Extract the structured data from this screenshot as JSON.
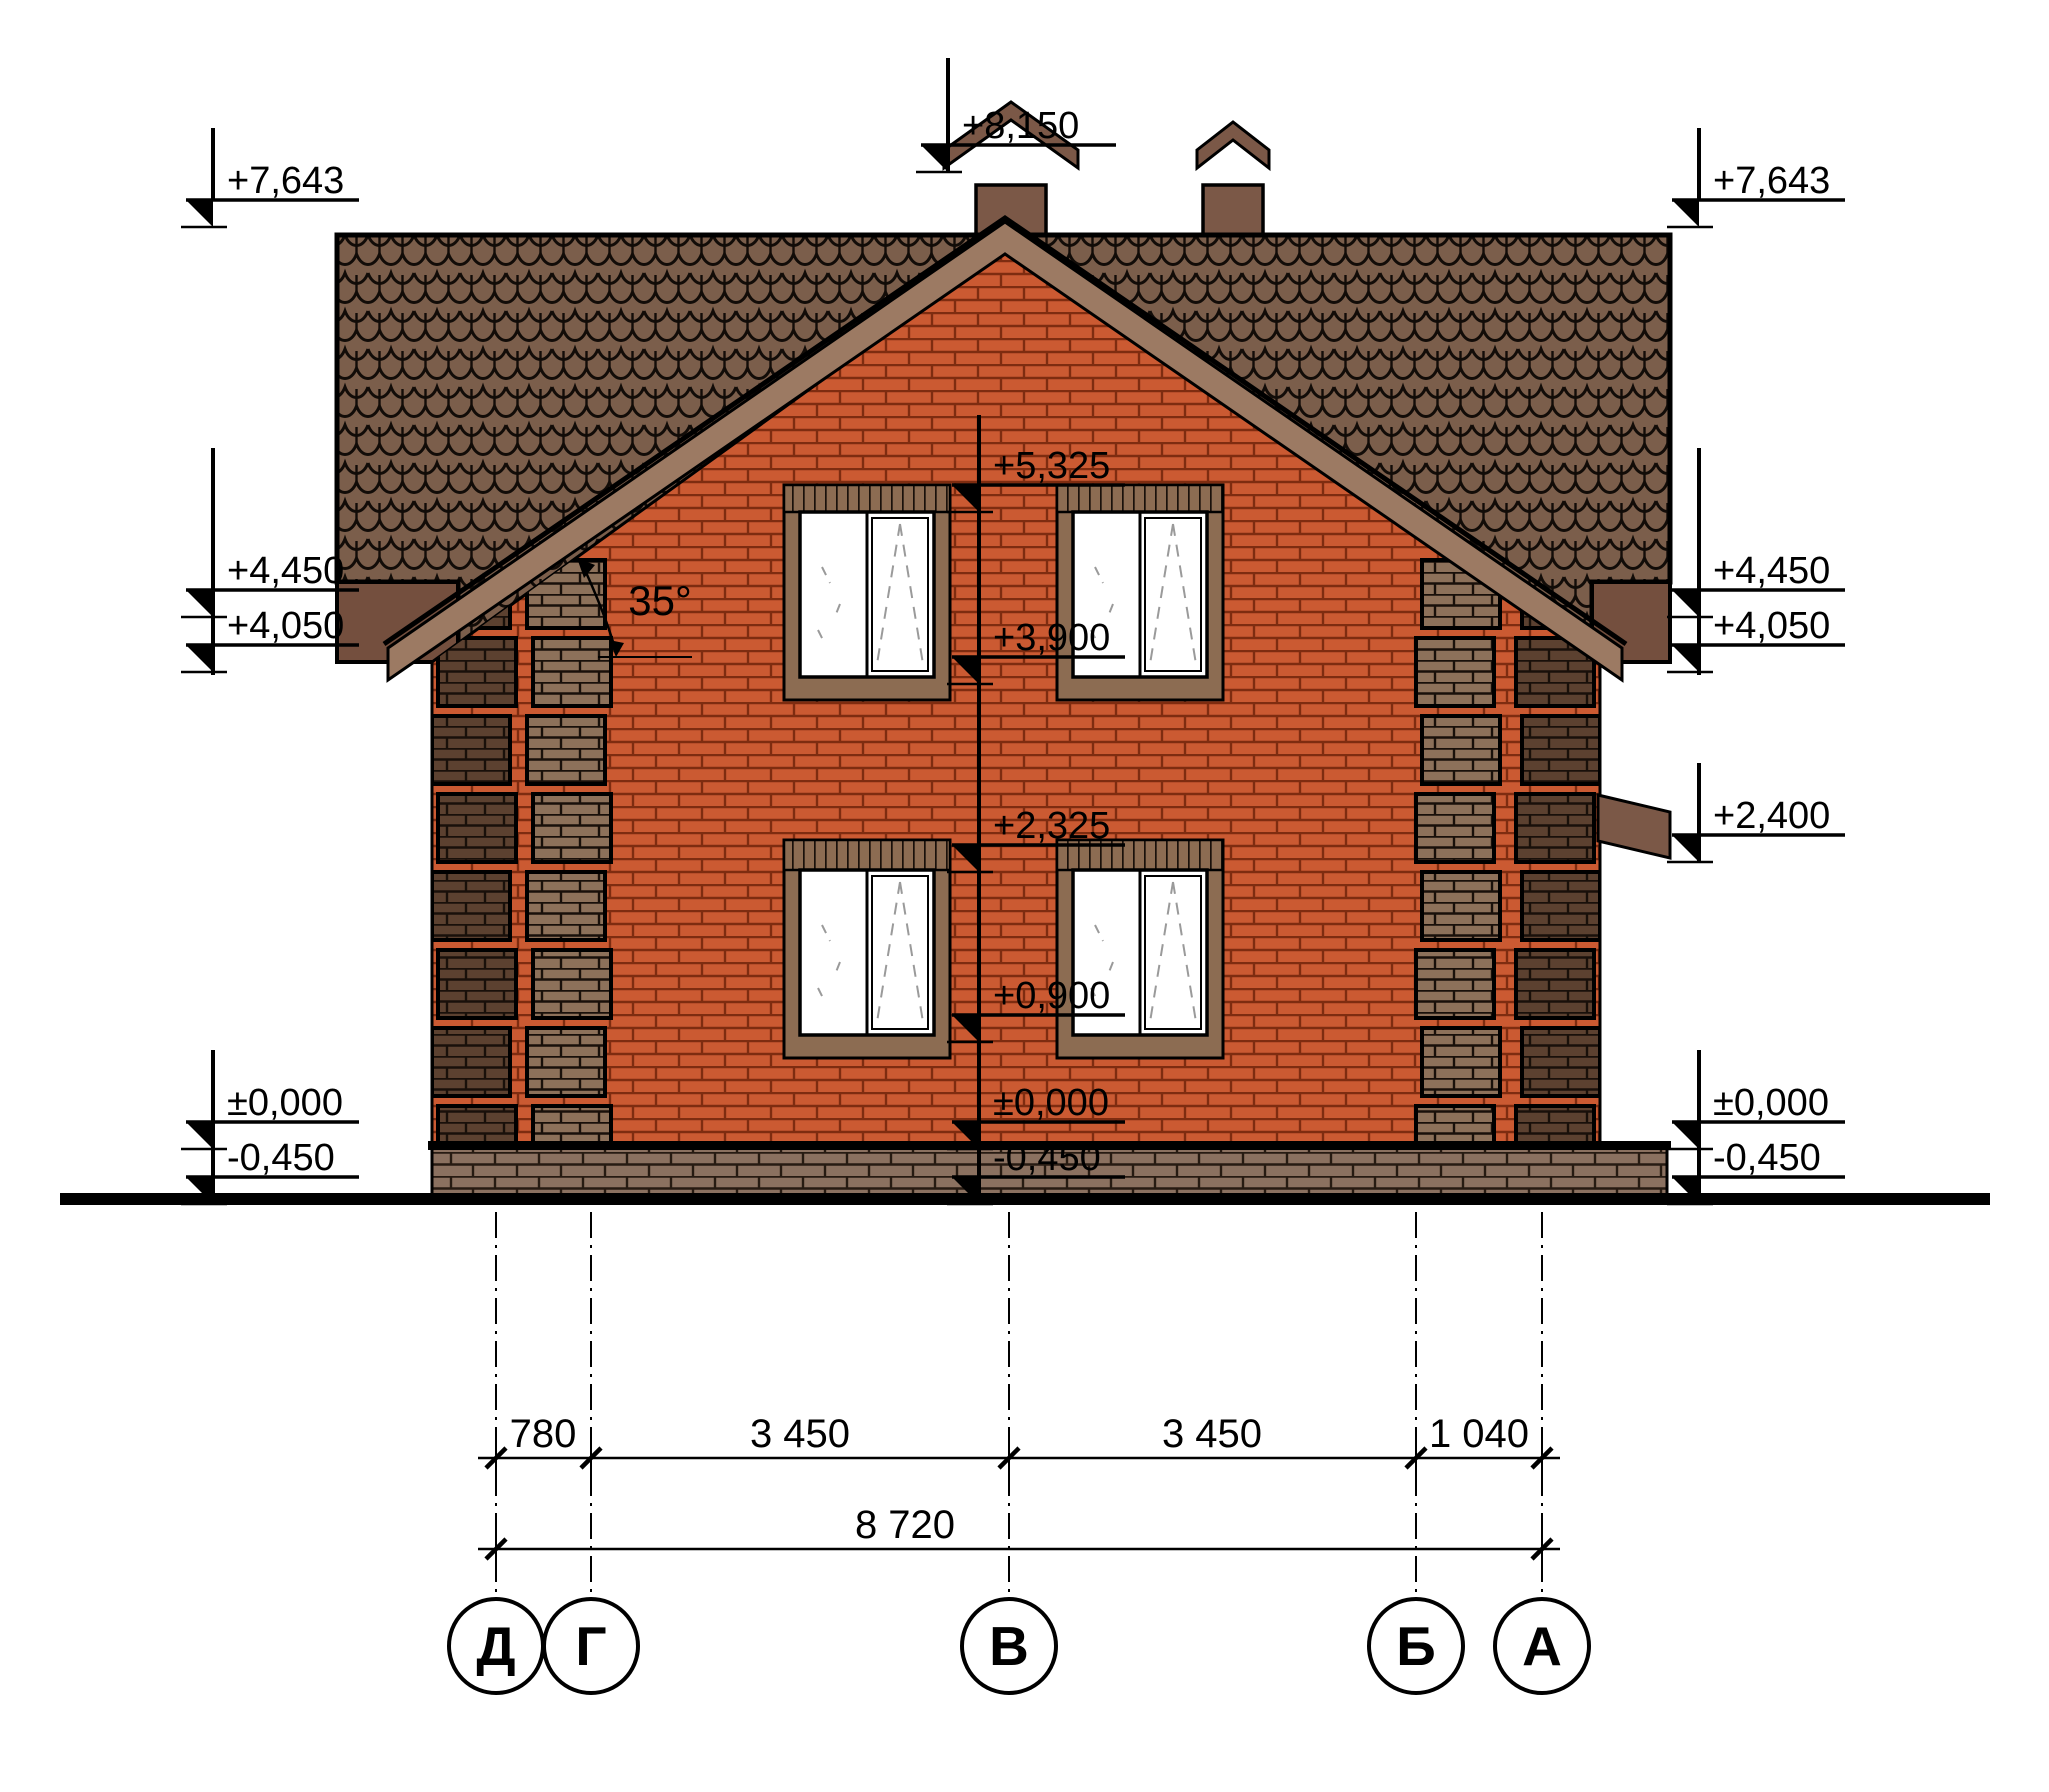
{
  "title": "House side elevation drawing",
  "elevation_marks": {
    "top_center": "+8,150",
    "left": [
      {
        "label": "+7,643"
      },
      {
        "label": "+4,450"
      },
      {
        "label": "+4,050"
      },
      {
        "label": "±0,000"
      },
      {
        "label": "-0,450"
      }
    ],
    "right": [
      {
        "label": "+7,643"
      },
      {
        "label": "+4,450"
      },
      {
        "label": "+4,050"
      },
      {
        "label": "+2,400"
      },
      {
        "label": "±0,000"
      },
      {
        "label": "-0,450"
      }
    ],
    "center": [
      {
        "label": "+5,325"
      },
      {
        "label": "+3,900"
      },
      {
        "label": "+2,325"
      },
      {
        "label": "+0,900"
      },
      {
        "label": "±0,000"
      },
      {
        "label": "-0,450"
      }
    ]
  },
  "roof": {
    "angle": "35°"
  },
  "dimensions": {
    "segments": [
      {
        "label": "780"
      },
      {
        "label": "3 450"
      },
      {
        "label": "3 450"
      },
      {
        "label": "1 040"
      }
    ],
    "total": {
      "label": "8 720"
    }
  },
  "axes": [
    {
      "label": "Д"
    },
    {
      "label": "Г"
    },
    {
      "label": "В"
    },
    {
      "label": "Б"
    },
    {
      "label": "А"
    }
  ],
  "colors": {
    "brick_red": "#cb5a32",
    "roof_tile": "#7b5e4b",
    "trim_dark_brown": "#744f3e",
    "fascia_brown": "#9c7a63",
    "quoin_dark": "#5c4130",
    "quoin_medium": "#8d715a",
    "plinth": "#8b7160",
    "line": "#000000",
    "window_symbol": "#9a9a9a"
  }
}
